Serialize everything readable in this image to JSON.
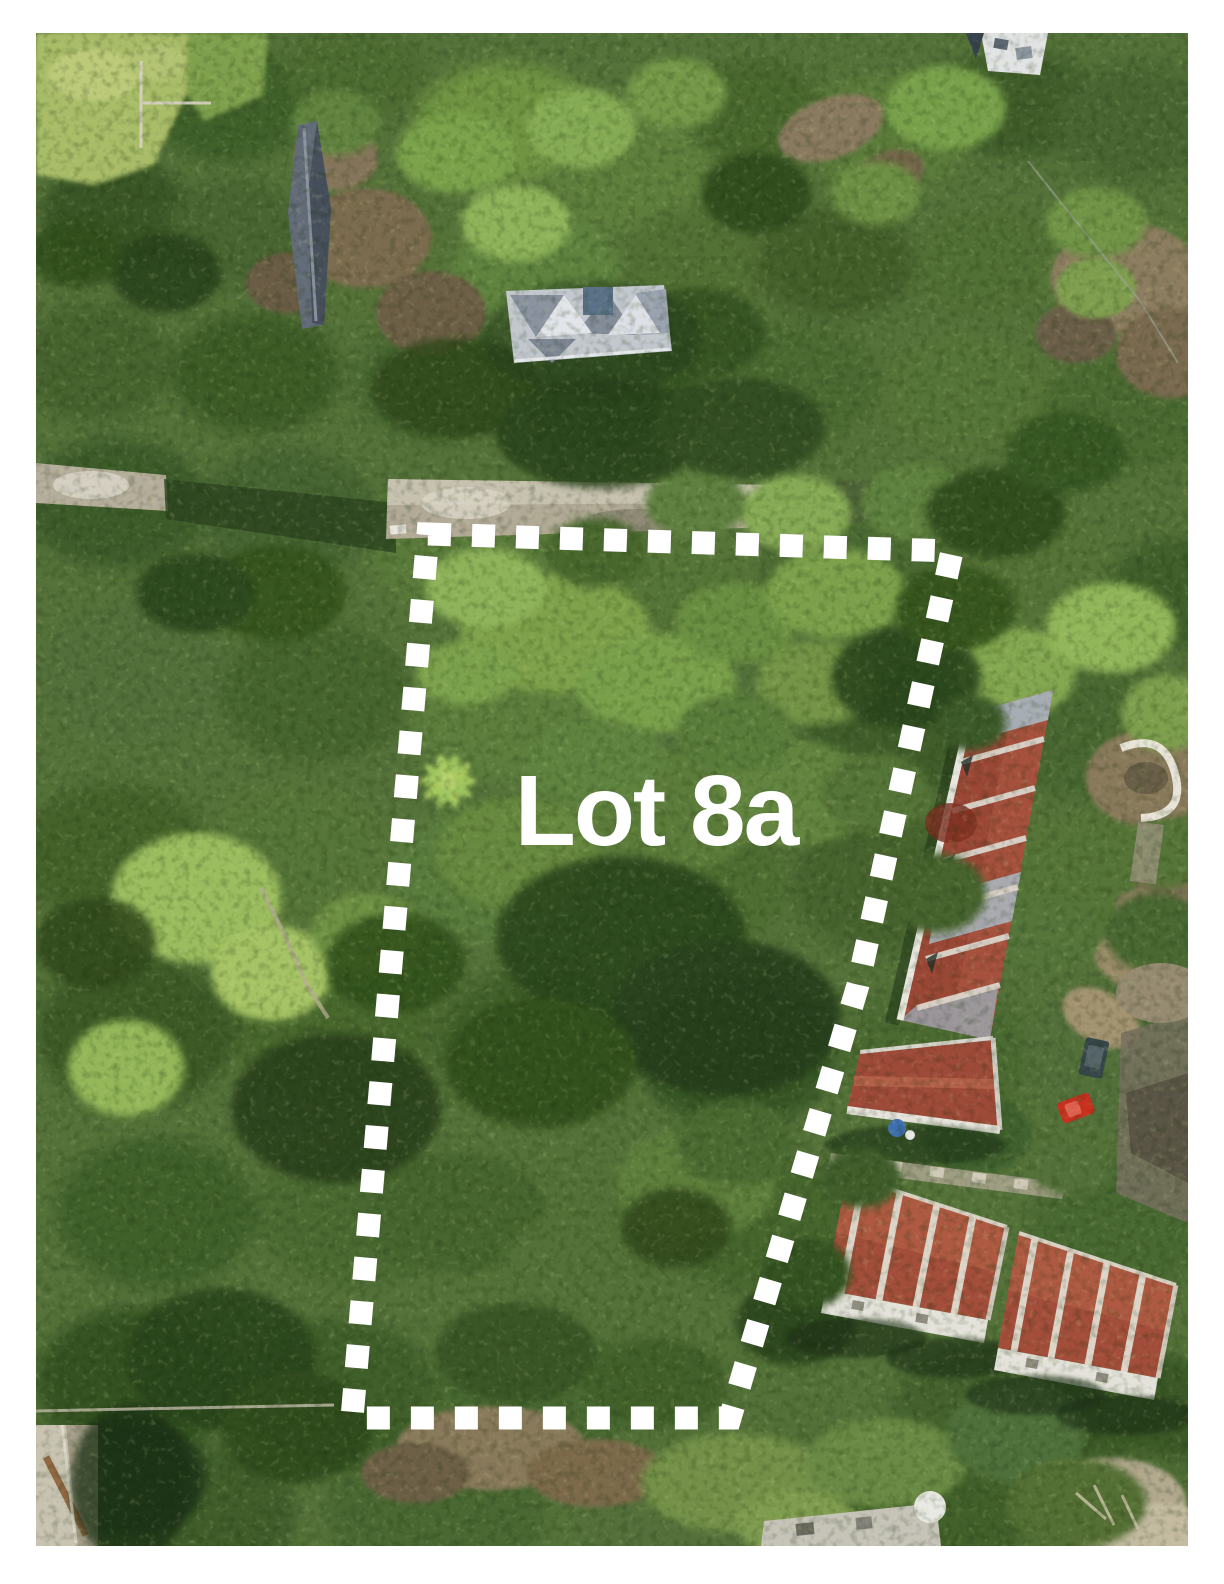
{
  "page": {
    "background_color": "#ffffff",
    "border": "white margin around aerial photograph"
  },
  "photo": {
    "kind": "aerial-drone-photograph-of-property",
    "label": {
      "text": "Lot 8a",
      "color": "#ffffff",
      "font_size_px": 100
    },
    "boundary": {
      "style": "dashed",
      "color": "#ffffff",
      "points": "392,501 916,518 822,952 694,1385 316,1385",
      "dash_length_px": 23,
      "dash_gap_px": 21,
      "stroke_width_px": 23
    },
    "palette": {
      "canopy_dark": "#2c441e",
      "canopy_mid": "#55723a",
      "canopy_light": "#9cbd5f",
      "lawn": "#a9bc68",
      "road_concrete": "#b2aa97",
      "dirt": "#8a7a5c",
      "roof_red": "#9b4736",
      "roof_red_light": "#ae5a45",
      "roof_gray": "#c3c8cf",
      "roof_slate": "#636c79",
      "parapet_white": "#e9e7e0",
      "car_red": "#c8311f"
    },
    "features": [
      {
        "name": "lot-boundary",
        "desc": "white dashed property line around vacant treed parcel"
      },
      {
        "name": "lot-label",
        "desc": "white bold lot number over canopy"
      },
      {
        "name": "hip-roof-house",
        "desc": "gray multi-gable hip roof house, top center"
      },
      {
        "name": "slate-roof-building",
        "desc": "narrow dark gray roof among trees, upper left"
      },
      {
        "name": "townhouse-row-east",
        "desc": "long red-roofed townhouse row, right side"
      },
      {
        "name": "cottage-east",
        "desc": "small red-roofed unit with blue tank"
      },
      {
        "name": "townhouse-blocks-south",
        "desc": "two red-roofed blocks with white ridge walls, bottom right"
      },
      {
        "name": "red-car",
        "desc": "red car parked on driveway, right side"
      },
      {
        "name": "concrete-road",
        "desc": "light concrete road along top edge of lot"
      },
      {
        "name": "lawn-top-left",
        "desc": "mowed yellow-green lawn in top-left corner"
      },
      {
        "name": "bottom-left-shed",
        "desc": "tan roof with rust streak, bottom-left corner"
      }
    ]
  }
}
